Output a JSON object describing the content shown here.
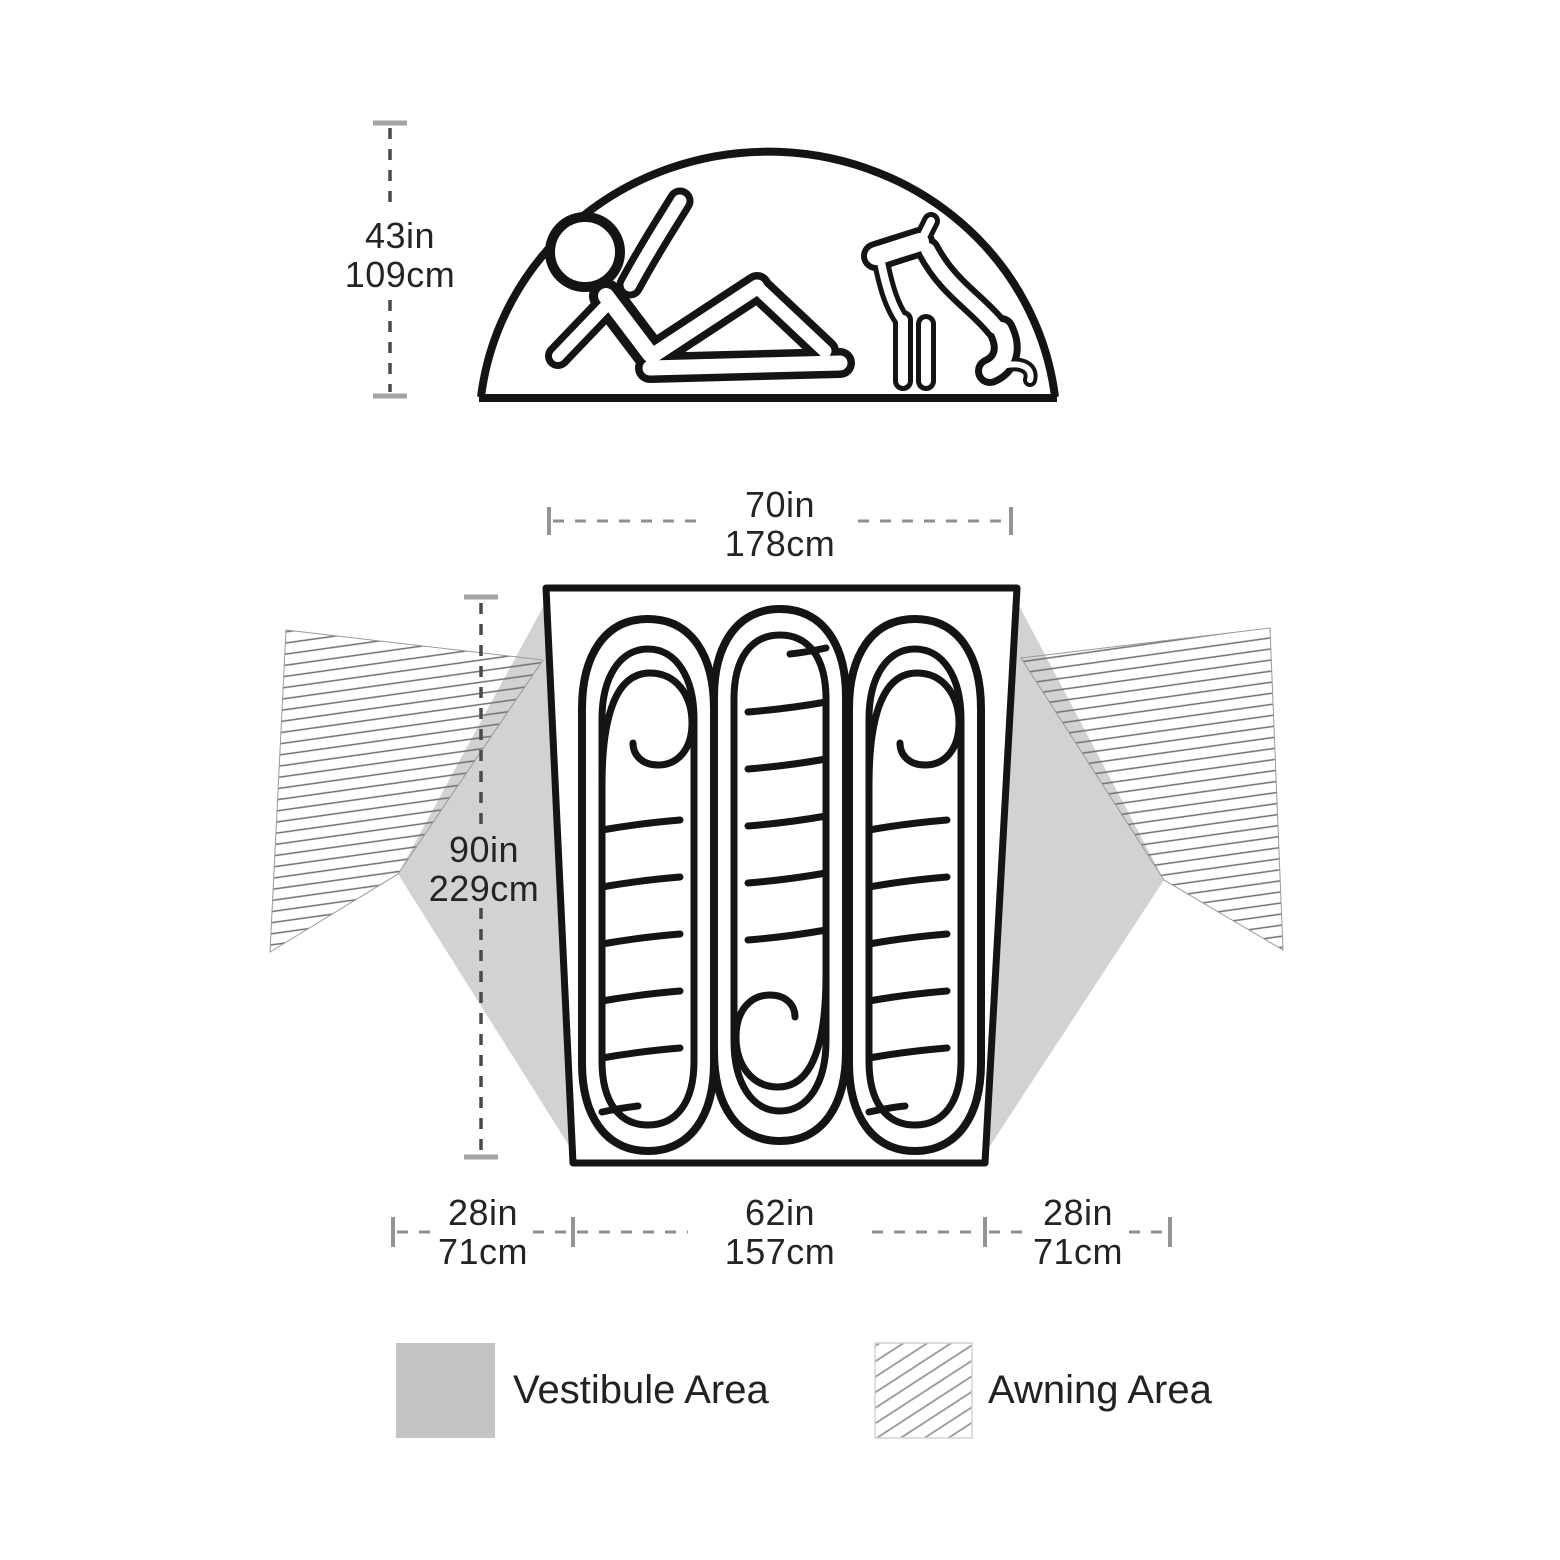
{
  "side_view": {
    "height": {
      "imperial": "43in",
      "metric": "109cm"
    }
  },
  "floor_plan": {
    "top_width": {
      "imperial": "70in",
      "metric": "178cm"
    },
    "length": {
      "imperial": "90in",
      "metric": "229cm"
    },
    "bottom_segments": [
      {
        "imperial": "28in",
        "metric": "71cm"
      },
      {
        "imperial": "62in",
        "metric": "157cm"
      },
      {
        "imperial": "28in",
        "metric": "71cm"
      }
    ],
    "sleeping_bag_count": 3
  },
  "legend": {
    "items": [
      {
        "label": "Vestibule Area",
        "swatch": "solid-gray"
      },
      {
        "label": "Awning Area",
        "swatch": "diagonal-hatch"
      }
    ]
  },
  "colors": {
    "outline": "#141414",
    "vestibule_fill": "#d2d2d4",
    "legend_vestibule_fill": "#c4c4c5",
    "hatch_line": "#6f6f6f",
    "dimension_line": "#8f8f8f",
    "dimension_dash_dark": "#4a4a4a",
    "text": "#242424"
  }
}
